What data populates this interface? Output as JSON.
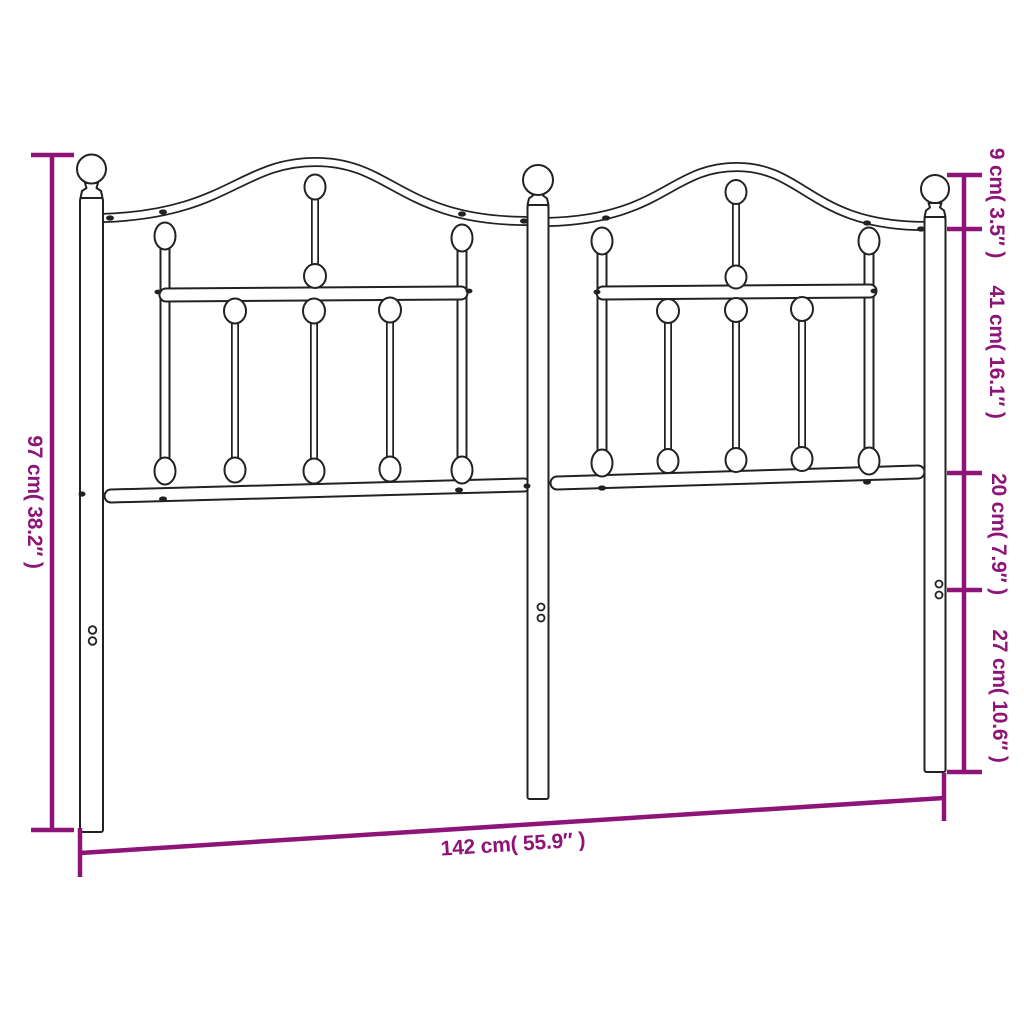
{
  "diagram": {
    "background_color": "#ffffff",
    "outline_color": "#222222",
    "dimension_color": "#8e1478",
    "dimensions": {
      "height": {
        "cm": 97,
        "inches": 38.2,
        "label": "97 cm( 38.2″ )"
      },
      "width": {
        "cm": 142,
        "inches": 55.9,
        "label": "142 cm( 55.9″ )"
      },
      "right_segments": [
        {
          "cm": 9,
          "inches": 3.5,
          "label": "9 cm( 3.5″ )"
        },
        {
          "cm": 41,
          "inches": 16.1,
          "label": "41 cm( 16.1″ )"
        },
        {
          "cm": 20,
          "inches": 7.9,
          "label": "20 cm( 7.9″ )"
        },
        {
          "cm": 27,
          "inches": 10.6,
          "label": "27 cm( 10.6″ )"
        }
      ]
    }
  }
}
